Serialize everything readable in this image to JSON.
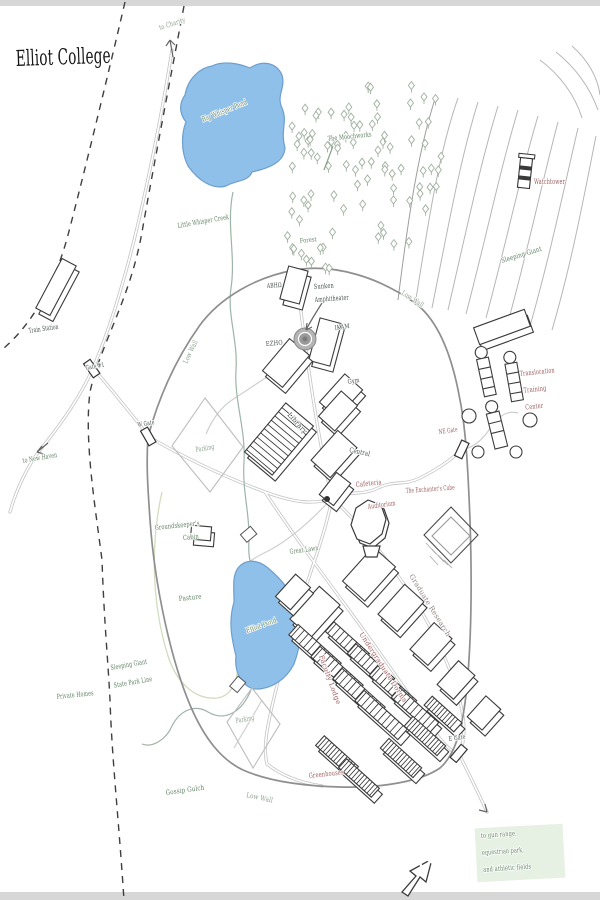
{
  "map": {
    "colors": {
      "title": "#161616",
      "dark": "#44504a",
      "green": "#5d7f5f",
      "palegreen": "#8aa08c",
      "maroon": "#9a5c5c",
      "graybrown": "#92807f",
      "water": "#8fc0ea",
      "water_stroke": "#6d9ecf",
      "wall": "#8f8f8f",
      "road": "#c4c4c4",
      "contour": "#b6b6b6",
      "tree": "#9fb09f",
      "creek": "#9db4a8",
      "boundary": "#3f3f3f",
      "highlight": "#e4efe0"
    },
    "labels": [
      {
        "id": "map-title",
        "text": "Elliot College",
        "x": 16,
        "y": 66,
        "size": 22,
        "color": "title",
        "rot": -2,
        "tl": 95
      },
      {
        "id": "to-charity",
        "text": "to Charity",
        "x": 160,
        "y": 30,
        "size": 7,
        "color": "palegreen",
        "rot": -18,
        "tl": 27
      },
      {
        "id": "big-whisper-pond",
        "text": "Big Whisper Pond",
        "x": 203,
        "y": 122,
        "size": 7.5,
        "color": "green",
        "rot": -22,
        "tl": 48
      },
      {
        "id": "moochworks",
        "text": "The Moochworks",
        "x": 328,
        "y": 141,
        "size": 7,
        "color": "green",
        "rot": -6,
        "tl": 44
      },
      {
        "id": "watchtower",
        "text": "Watchtower",
        "x": 534,
        "y": 184,
        "size": 7,
        "color": "maroon",
        "rot": 0,
        "tl": 31
      },
      {
        "id": "sleeping-giant",
        "text": "Sleeping Giant",
        "x": 502,
        "y": 263,
        "size": 7,
        "color": "green",
        "rot": -17,
        "tl": 42
      },
      {
        "id": "little-whisper-creek",
        "text": "Little Whisper Creek",
        "x": 178,
        "y": 228,
        "size": 7,
        "color": "green",
        "rot": -10,
        "tl": 52
      },
      {
        "id": "forest",
        "text": "Forest",
        "x": 300,
        "y": 243,
        "size": 6.5,
        "color": "green",
        "rot": -6,
        "tl": 17
      },
      {
        "id": "train-station",
        "text": "Train Station",
        "x": 29,
        "y": 333,
        "size": 7,
        "color": "dark",
        "rot": -8,
        "tl": 30
      },
      {
        "id": "gate-1",
        "text": "Gate #1",
        "x": 86,
        "y": 370,
        "size": 6.5,
        "color": "dark",
        "rot": -10,
        "tl": 19
      },
      {
        "id": "low-wall-west",
        "text": "Low Wall",
        "x": 187,
        "y": 364,
        "size": 7,
        "color": "palegreen",
        "rot": -64,
        "tl": 25
      },
      {
        "id": "low-wall-ne",
        "text": "Low Wall",
        "x": 401,
        "y": 294,
        "size": 7,
        "color": "palegreen",
        "rot": 33,
        "tl": 25
      },
      {
        "id": "low-wall-south",
        "text": "Low Wall",
        "x": 246,
        "y": 797,
        "size": 7,
        "color": "palegreen",
        "rot": 12,
        "tl": 27
      },
      {
        "id": "w-gate",
        "text": "W Gate",
        "x": 138,
        "y": 427,
        "size": 6.5,
        "color": "dark",
        "rot": -10,
        "tl": 17
      },
      {
        "id": "to-new-haven",
        "text": "to New Haven",
        "x": 23,
        "y": 463,
        "size": 7,
        "color": "green",
        "rot": -10,
        "tl": 35
      },
      {
        "id": "parking-north",
        "text": "Parking",
        "x": 196,
        "y": 452,
        "size": 7,
        "color": "palegreen",
        "rot": -10,
        "tl": 19
      },
      {
        "id": "abh",
        "text": "ABHΩ",
        "x": 267,
        "y": 288,
        "size": 6.5,
        "color": "dark",
        "rot": -4,
        "tl": 15
      },
      {
        "id": "sunken-amphitheater",
        "lines": [
          "Sunken",
          "Amphitheater"
        ],
        "x": 314,
        "y": 289,
        "size": 7,
        "color": "dark",
        "rot": -4,
        "lh": 13,
        "tls": [
          20,
          34
        ]
      },
      {
        "id": "ikam",
        "text": "IKAM",
        "x": 335,
        "y": 330,
        "size": 6.5,
        "color": "dark",
        "rot": -8,
        "tl": 15
      },
      {
        "id": "ezho",
        "text": "EZHO",
        "x": 266,
        "y": 346,
        "size": 6.5,
        "color": "dark",
        "rot": -5,
        "tl": 17
      },
      {
        "id": "gym",
        "text": "Gym",
        "x": 348,
        "y": 384,
        "size": 6.5,
        "color": "dark",
        "rot": -10,
        "tl": 12
      },
      {
        "id": "library",
        "text": "Library",
        "x": 287,
        "y": 415,
        "size": 7,
        "color": "dark",
        "rot": 48,
        "tl": 26
      },
      {
        "id": "central",
        "text": "Central",
        "x": 349,
        "y": 452,
        "size": 7,
        "color": "dark",
        "rot": 12,
        "tl": 21
      },
      {
        "id": "ne-gate",
        "text": "NE Gate",
        "x": 439,
        "y": 434,
        "size": 6.5,
        "color": "maroon",
        "rot": -8,
        "tl": 19
      },
      {
        "id": "translocation-training-center",
        "lines": [
          "Translocation",
          "Training",
          "Center"
        ],
        "x": 520,
        "y": 376,
        "size": 7,
        "color": "maroon",
        "rot": -6,
        "lh": 17,
        "dx": [
          0,
          2,
          2
        ],
        "tls": [
          35,
          23,
          18
        ]
      },
      {
        "id": "cafeteria",
        "text": "Cafeteria",
        "x": 356,
        "y": 487,
        "size": 7,
        "color": "maroon",
        "rot": -6,
        "tl": 26
      },
      {
        "id": "auditorium",
        "text": "Auditorium",
        "x": 368,
        "y": 509,
        "size": 7,
        "color": "maroon",
        "rot": -8,
        "tl": 28
      },
      {
        "id": "enchanters-cube",
        "text": "The Enchanter's Cube",
        "x": 406,
        "y": 493,
        "size": 7,
        "color": "maroon",
        "rot": -4,
        "tl": 49
      },
      {
        "id": "groundskeepers-cabin",
        "lines": [
          "Groundskeeper's",
          "Cabin"
        ],
        "x": 155,
        "y": 530,
        "size": 7,
        "color": "green",
        "rot": -6,
        "lh": 13,
        "dx": [
          0,
          27
        ],
        "tls": [
          45,
          16
        ]
      },
      {
        "id": "great-lawn",
        "text": "Great Lawn",
        "x": 290,
        "y": 554,
        "size": 7,
        "color": "green",
        "rot": -8,
        "tl": 29
      },
      {
        "id": "pasture",
        "text": "Pasture",
        "x": 179,
        "y": 601,
        "size": 7,
        "color": "green",
        "rot": -6,
        "tl": 23
      },
      {
        "id": "elliot-pond",
        "text": "Elliot Pond",
        "x": 247,
        "y": 633,
        "size": 7,
        "color": "green",
        "rot": -20,
        "tl": 32
      },
      {
        "id": "graduate-research",
        "text": "Graduate Research",
        "x": 409,
        "y": 576,
        "size": 7,
        "color": "graybrown",
        "rot": 58,
        "tl": 72
      },
      {
        "id": "undergraduate-dorms",
        "text": "Undergraduate Dorms",
        "x": 359,
        "y": 634,
        "size": 6.8,
        "color": "maroon",
        "rot": 57,
        "tl": 82
      },
      {
        "id": "faculty-lodge",
        "text": "Faculty Lodge",
        "x": 319,
        "y": 656,
        "size": 6.8,
        "color": "maroon",
        "rot": 70,
        "tl": 52
      },
      {
        "id": "state-park-line",
        "lines": [
          "Sleeping Giant",
          "State Park Line"
        ],
        "x": 111,
        "y": 670,
        "size": 7,
        "color": "green",
        "rot": -10,
        "lh": 18,
        "tls": [
          37,
          39
        ]
      },
      {
        "id": "private-homes",
        "text": "Private Homes",
        "x": 57,
        "y": 699,
        "size": 7,
        "color": "green",
        "rot": -6,
        "tl": 37
      },
      {
        "id": "gossip-gulch",
        "text": "Gossip Gulch",
        "x": 166,
        "y": 795,
        "size": 7,
        "color": "green",
        "rot": -8,
        "tl": 39
      },
      {
        "id": "parking-south",
        "text": "Parking",
        "x": 236,
        "y": 723,
        "size": 7,
        "color": "palegreen",
        "rot": -10,
        "tl": 19
      },
      {
        "id": "greenhouses",
        "text": "Greenhouses",
        "x": 309,
        "y": 778,
        "size": 7,
        "color": "maroon",
        "rot": -6,
        "tl": 35
      },
      {
        "id": "e-gate",
        "text": "E Gate",
        "x": 449,
        "y": 741,
        "size": 6.5,
        "color": "dark",
        "rot": -8,
        "tl": 17
      },
      {
        "id": "to-gun-range",
        "lines": [
          "to gun range,",
          "equestrian park,",
          "and athletic fields"
        ],
        "x": 481,
        "y": 838,
        "size": 7,
        "color": "green",
        "rot": -4,
        "lh": 17,
        "tls": [
          36,
          42,
          48
        ]
      },
      {
        "id": "compass-n",
        "text": "N",
        "x": 418,
        "y": 874,
        "size": 32,
        "color": "dark",
        "rot": -18,
        "style": "outline"
      }
    ]
  }
}
